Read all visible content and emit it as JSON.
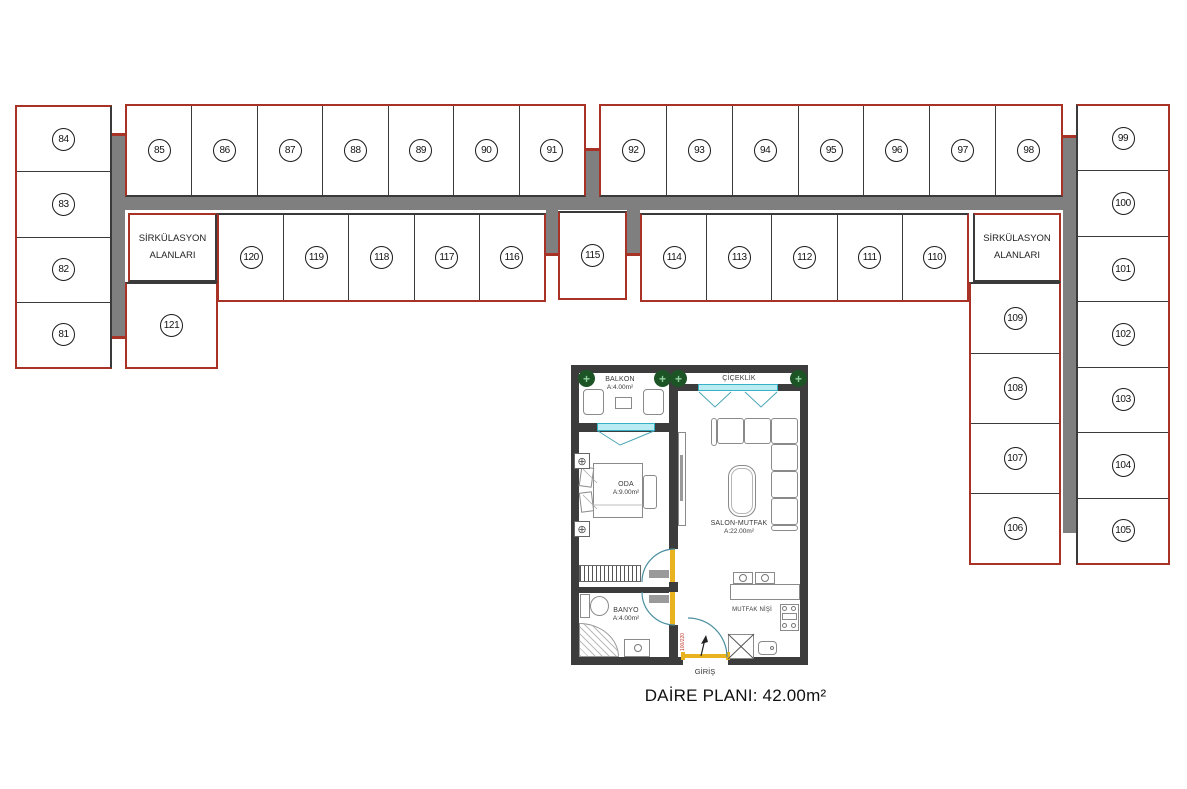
{
  "units": {
    "left_column": [
      "84",
      "83",
      "82",
      "81"
    ],
    "top_row_left": [
      "85",
      "86",
      "87",
      "88",
      "89",
      "90",
      "91"
    ],
    "top_row_right": [
      "92",
      "93",
      "94",
      "95",
      "96",
      "97",
      "98"
    ],
    "right_column": [
      "99",
      "100",
      "101",
      "102",
      "103",
      "104",
      "105"
    ],
    "row2_left": [
      "120",
      "119",
      "118",
      "117",
      "116"
    ],
    "unit_mid": "115",
    "row2_right": [
      "114",
      "113",
      "112",
      "111",
      "110"
    ],
    "inner_right_column": [
      "109",
      "108",
      "107",
      "106"
    ],
    "unit_bottom_left": "121"
  },
  "circulation": {
    "line1": "SİRKÜLASYON",
    "line2": "ALANLARI"
  },
  "apartment": {
    "balcony_name": "BALKON",
    "balcony_area": "A:4.00m²",
    "flowerbed_name": "ÇİÇEKLİK",
    "room_name": "ODA",
    "room_area": "A:9.00m²",
    "living_name": "SALON-MUTFAK",
    "living_area": "A:22.00m²",
    "kitchen_name": "MUTFAK NİŞİ",
    "bath_name": "BANYO",
    "bath_area": "A:4.00m²",
    "entrance_name": "GİRİŞ",
    "door_size": "100/220",
    "caption": "DAİRE PLANI: 42.00m²"
  },
  "colors": {
    "red_border": "#a93226",
    "corridor_gray": "#7f7f7f",
    "wall_dark": "#3c3c3c",
    "window_cyan": "#b9ecf2",
    "door_teal": "#4a96a6",
    "door_yellow": "#e9b320",
    "tree_green": "#1c5426",
    "door_label_red": "#c0392b"
  }
}
